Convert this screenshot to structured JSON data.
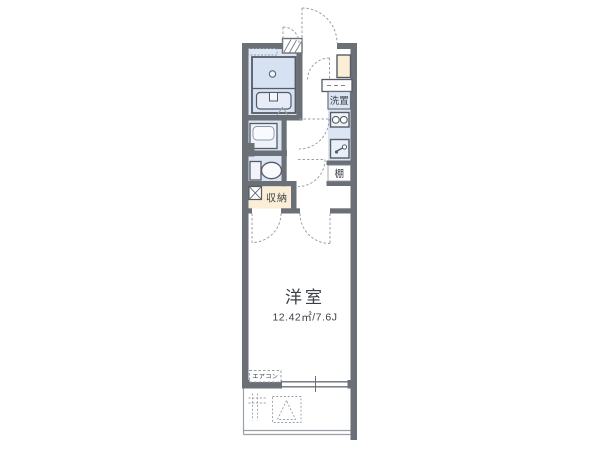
{
  "floor_plan": {
    "main_room": {
      "label": "洋室",
      "area_label": "12.42㎡/7.6J"
    },
    "labels": {
      "storage": "収納",
      "washing_machine": "洗置",
      "shelf": "棚",
      "air_conditioner": "エアコン"
    },
    "icons": {
      "bathtub": "bathtub-symbol",
      "washbasin": "washbasin-symbol",
      "toilet": "toilet-symbol",
      "stove": "two-burner-stove-symbol",
      "sink": "kitchen-sink-faucet-symbol",
      "evacuation_hatch": "balcony-hatch-triangle-symbol"
    },
    "colors": {
      "wall": "#6b7077",
      "wet_area_fill": "#dbe5f3",
      "fixture_fill": "#eef2f9",
      "storage_fill": "#fbeed6",
      "line_gray": "#9aa0a8",
      "text": "#3a3f46"
    }
  }
}
